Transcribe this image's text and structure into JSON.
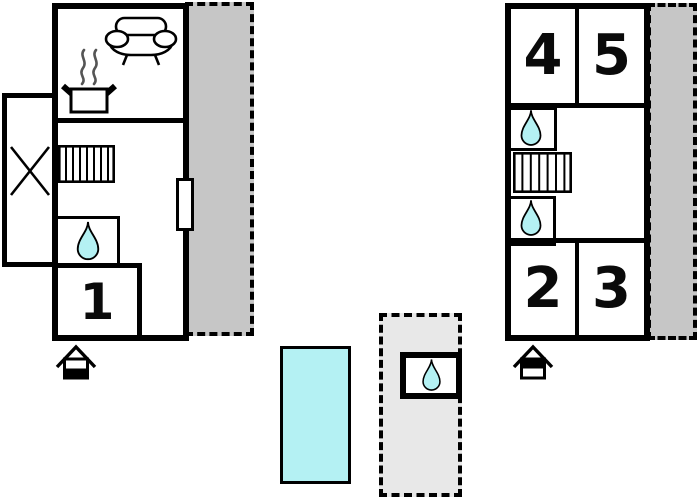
{
  "rooms": {
    "room1": "1",
    "room2": "2",
    "room3": "3",
    "room4": "4",
    "room5": "5"
  },
  "colors": {
    "wall": "#000000",
    "floor": "#ffffff",
    "terrace": "#c6c6c6",
    "courtyard": "#e8e8e8",
    "water": "#b4f1f3"
  },
  "icons": {
    "sofa": "sofa-icon",
    "cooking_pot": "cooking-pot-icon",
    "stairs": "stairs-icon",
    "water_drop": "water-drop-icon",
    "entrance": "entrance-house-icon",
    "x_marker": "x-marker-icon",
    "pool": "swimming-pool"
  }
}
